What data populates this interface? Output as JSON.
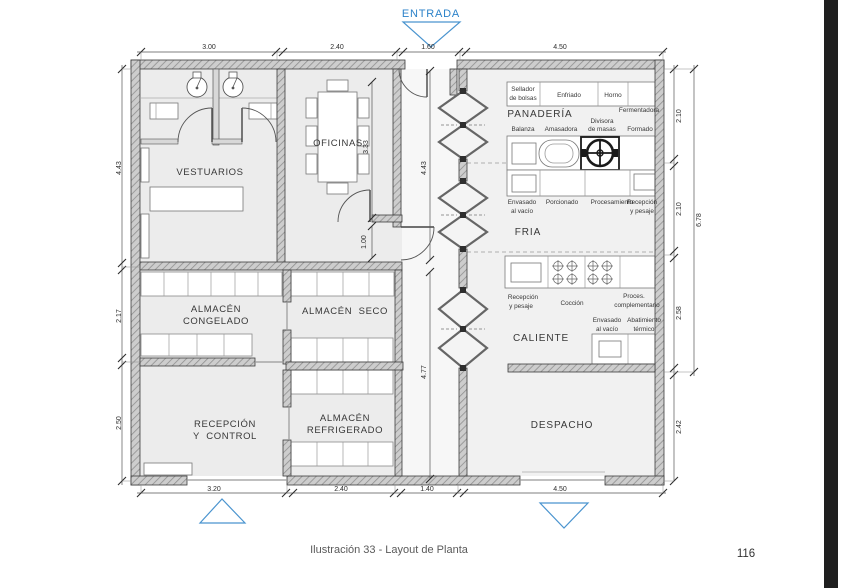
{
  "entrance": {
    "label": "ENTRADA"
  },
  "caption": {
    "text": "Ilustración 33 - Layout de Planta",
    "page_number": "116"
  },
  "rooms": {
    "vestuarios": "VESTUARIOS",
    "oficinas": "OFICINAS",
    "panaderia": "PANADERÍA",
    "fria": "FRIA",
    "caliente": "CALIENTE",
    "despacho": "DESPACHO",
    "congelado1": "ALMACÉN",
    "congelado2": "CONGELADO",
    "seco": "ALMACÉN  SECO",
    "recepcion1": "RECEPCIÓN",
    "recepcion2": "Y  CONTROL",
    "refrigerado1": "ALMACÉN",
    "refrigerado2": "REFRIGERADO"
  },
  "equip": {
    "sellador1": "Sellador",
    "sellador2": "de bolsas",
    "enfriado": "Enfriado",
    "horno": "Horno",
    "fermentadora": "Fermentadora",
    "balanza": "Balanza",
    "amasadora": "Amasadora",
    "divisora1": "Divisora",
    "divisora2": "de masas",
    "formado": "Formado",
    "envasado1": "Envasado",
    "envasado2": "al vacío",
    "porcionado": "Porcionado",
    "procesamiento": "Procesamiento",
    "recpesaje1": "Recepción",
    "recpesaje2": "y pesaje",
    "recpesaje3": "Recepción",
    "recpesaje4": "y pesaje",
    "coccion": "Cocción",
    "proces1": "Proces.",
    "proces2": "complementario",
    "envasadoc1": "Envasado",
    "envasadoc2": "al vacío",
    "abatimiento1": "Abatimiento",
    "abatimiento2": "térmico"
  },
  "dims": {
    "top": [
      "3.00",
      "2.40",
      "1.60",
      "4.50"
    ],
    "bottom": [
      "3.20",
      "2.40",
      "1.40",
      "4.50"
    ],
    "left": [
      "4.43",
      "2.17",
      "2.50"
    ],
    "right": [
      "2.10",
      "2.10",
      "2.58",
      "2.42"
    ],
    "right_total": "6.78",
    "inner": {
      "oficinas": "3.33",
      "door": "1.00",
      "hall_top": "4.43",
      "hall_bottom": "4.77"
    }
  },
  "colors": {
    "accent_blue": "#2b82c9",
    "wall_gray": "#cdcdcd",
    "line_dark": "#3c3c3c",
    "edge_bar_black": "#1f1f1f"
  }
}
